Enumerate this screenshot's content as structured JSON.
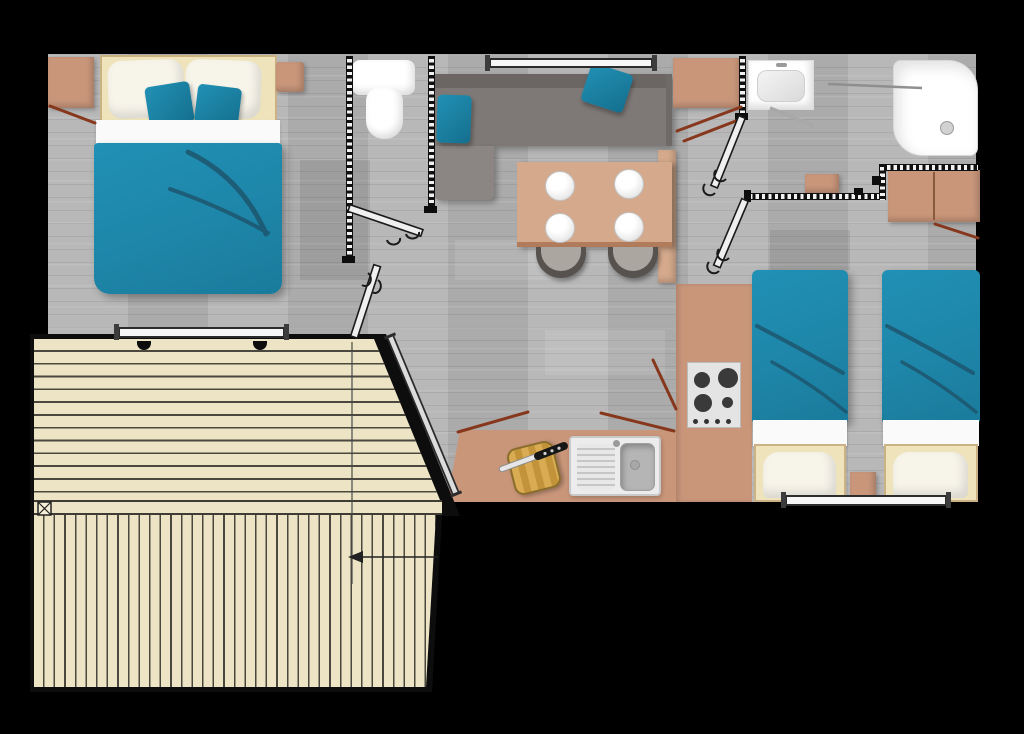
{
  "document": {
    "type": "floor-plan",
    "subject": "mobile-home holiday lodge, top view with angled wooden terrace",
    "canvas": {
      "width": 1024,
      "height": 734
    },
    "visible_text": ""
  },
  "colors": {
    "background": "#000000",
    "floor": "#b4b4b4",
    "wall": "#0d0d0d",
    "teal": "#1e86a9",
    "teal_dark": "#1d566e",
    "tan": "#c9967a",
    "tan_dark": "#b07c5c",
    "tan_light": "#d4a98c",
    "cream": "#eee3ba",
    "pillow": "#f7f4ea",
    "deck": "#ece4c4",
    "deck_line": "#4a473e",
    "sofa": "#7e7977",
    "sofa_back": "#6b6663",
    "sofa_corner": "#8b8683",
    "chair": "#57524e",
    "chair_seat": "#aba69f",
    "red_line": "#87371c",
    "fixture": "#ffffff",
    "steel": "#ececec",
    "basin": "#b5b5b5",
    "burner": "#3a3a3a",
    "board": "#d5a64c"
  },
  "rooms": [
    {
      "id": "master-bedroom",
      "position": "top-left",
      "furniture": [
        "corner-wardrobe",
        "double-bed with 2 pillows and 2 teal cushions",
        "bedside-shelf",
        "window on south wall"
      ]
    },
    {
      "id": "wc",
      "position": "top-center-left",
      "furniture": [
        "toilet",
        "swing-door"
      ]
    },
    {
      "id": "living-room",
      "position": "top-center",
      "furniture": [
        "corner-sofa with 2 teal cushions",
        "window on north wall",
        "dining-table with 4 plates",
        "2 chairs",
        "tall-cabinet",
        "fridge-cabinet"
      ]
    },
    {
      "id": "bathroom",
      "position": "top-right",
      "furniture": [
        "washbasin",
        "shower with drain",
        "shower-screen",
        "towel"
      ]
    },
    {
      "id": "twin-bedroom",
      "position": "right",
      "furniture": [
        "twin-bed-1",
        "twin-bed-2",
        "nightstand",
        "wardrobe",
        "window on south wall"
      ]
    },
    {
      "id": "kitchen",
      "position": "bottom-center",
      "furniture": [
        "L-shaped counter",
        "hob with 4 burners and 4 knobs",
        "sink with drainboard",
        "cutting-board",
        "knife"
      ]
    },
    {
      "id": "terrace",
      "position": "bottom-left",
      "furniture": [
        "upper deck horizontal planks",
        "lower deck vertical planks",
        "sliding-bay railing on diagonal edge",
        "entry-arrow annotation",
        "crossed-box marker"
      ]
    }
  ],
  "counts": {
    "beds": 3,
    "plates": 4,
    "dining_chairs": 2,
    "hob_burners": 4,
    "hob_knobs": 4,
    "windows": 3,
    "swing_doors": 4
  }
}
